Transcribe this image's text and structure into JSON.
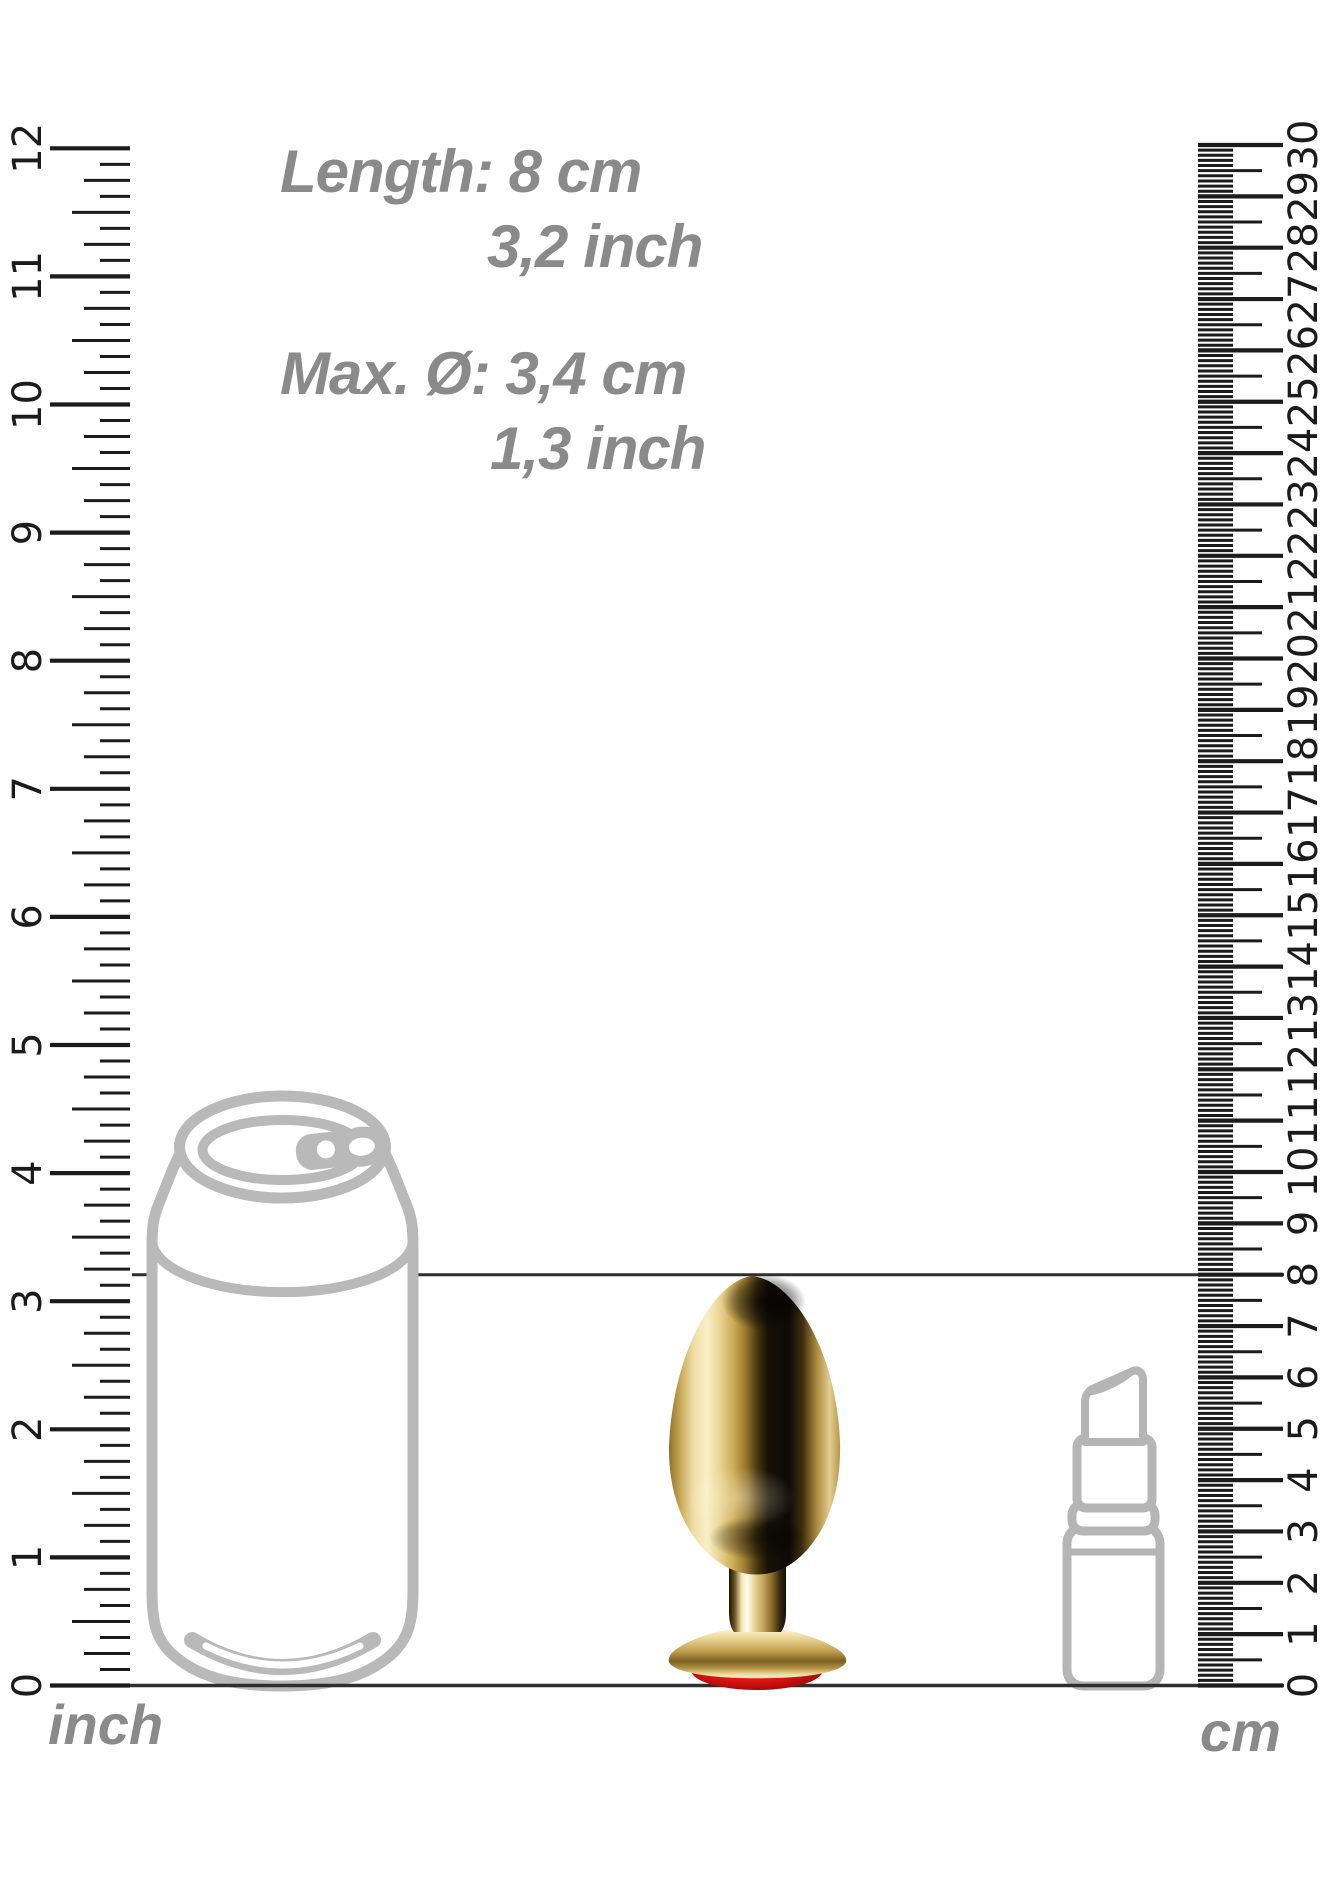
{
  "dimensions": {
    "length_metric": "Length: 8 cm",
    "length_imperial": "3,2 inch",
    "diameter_metric": "Max. Ø: 3,4 cm",
    "diameter_imperial": "1,3 inch"
  },
  "measurement": {
    "length_cm": 8,
    "max_diameter_cm": 3.4
  },
  "rulers": {
    "left": {
      "unit_label": "inch",
      "subdivisions_per_unit": 8,
      "tick_labels": [
        "0",
        "1",
        "2",
        "3",
        "4",
        "5",
        "6",
        "7",
        "8",
        "9",
        "10",
        "11",
        "12"
      ]
    },
    "right": {
      "unit_label": "cm",
      "subdivisions_per_unit": 10,
      "tick_labels": [
        "0",
        "1",
        "2",
        "3",
        "4",
        "5",
        "6",
        "7",
        "8",
        "9",
        "10",
        "11",
        "12",
        "13",
        "14",
        "15",
        "16",
        "17",
        "18",
        "19",
        "20",
        "21",
        "22",
        "23",
        "24",
        "25",
        "26",
        "27",
        "28",
        "29",
        "30"
      ]
    }
  },
  "colors": {
    "ruler_ink": "#1b1b1b",
    "drawing_gray": "#b9b9b9",
    "label_gray": "#8a8a8a",
    "measure_line": "#2f2f2f",
    "gold": "#d4b46a",
    "gem_red": "#e81c15"
  }
}
